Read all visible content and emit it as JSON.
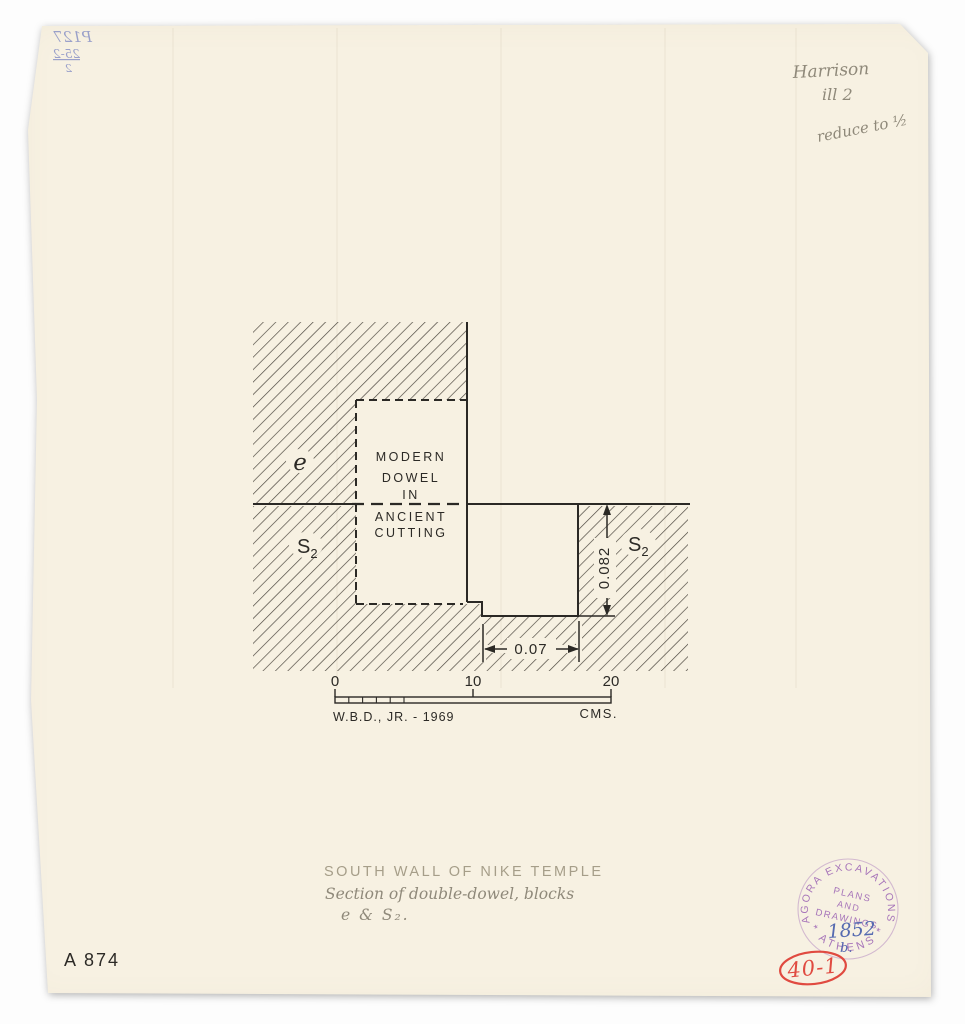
{
  "drawing": {
    "dowel_lines": [
      "MODERN",
      "DOWEL",
      "IN",
      "ANCIENT",
      "CUTTING"
    ],
    "blocks": {
      "e": "e",
      "s": "S",
      "sub": "2"
    },
    "dims": {
      "vertical": "0.082",
      "horizontal": "0.07"
    },
    "scalebar": {
      "t0": "0",
      "t10": "10",
      "t20": "20",
      "unit": "CMS.",
      "credit": "W.B.D., JR. - 1969"
    }
  },
  "caption": {
    "l1": "SOUTH WALL OF NIKE TEMPLE",
    "l2": "Section of double-dowel, blocks",
    "l3": "e & S₂."
  },
  "notes_top_right": {
    "l1": "Harrison",
    "l2": "ill 2",
    "l3": "reduce to ½"
  },
  "bleedthrough": {
    "l1": "P127",
    "l2": "25-2",
    "l3": "2"
  },
  "ids": {
    "catalog": "A 874",
    "plate": "40-1"
  },
  "stamp": {
    "arc_top": "AGORA EXCAVATIONS",
    "arc_bottom": "* ATHENS *",
    "l1": "PLANS",
    "l2": "AND",
    "l3": "DRAWINGS",
    "number": "1852",
    "suffix": "b."
  },
  "colors": {
    "paper": "#f7f1e2",
    "ink": "#2b2925",
    "hatch": "#4a453d",
    "pencil": "#8f897a",
    "stamp_purple": "#9c64b4",
    "stamp_blue": "#3f58aa",
    "red": "#e04a40",
    "bleed_blue": "#8a93c6"
  }
}
